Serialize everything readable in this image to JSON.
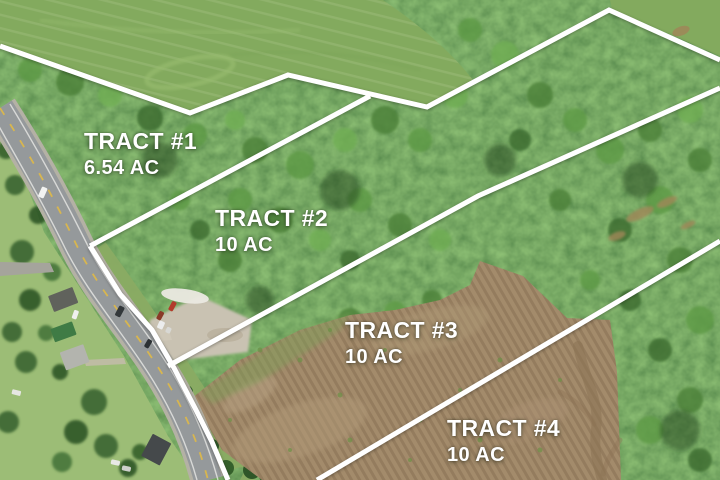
{
  "scene": {
    "type": "aerial-drone-photo-with-survey-overlay",
    "boundary_line_color": "#ffffff",
    "label_text_color": "#ffffff"
  },
  "tracts": [
    {
      "name": "TRACT #1",
      "acreage": "6.54 AC"
    },
    {
      "name": "TRACT #2",
      "acreage": "10 AC"
    },
    {
      "name": "TRACT #3",
      "acreage": "10 AC"
    },
    {
      "name": "TRACT #4",
      "acreage": "10 AC"
    }
  ],
  "colors": {
    "hay_field": "#83aa5e",
    "forest": "#3d6632",
    "tilled_field": "#a38b6b",
    "road_asphalt": "#95999b",
    "road_centerline": "#d8b64f",
    "gravel": "#c9c2b2",
    "lawn": "#9cbd76"
  }
}
